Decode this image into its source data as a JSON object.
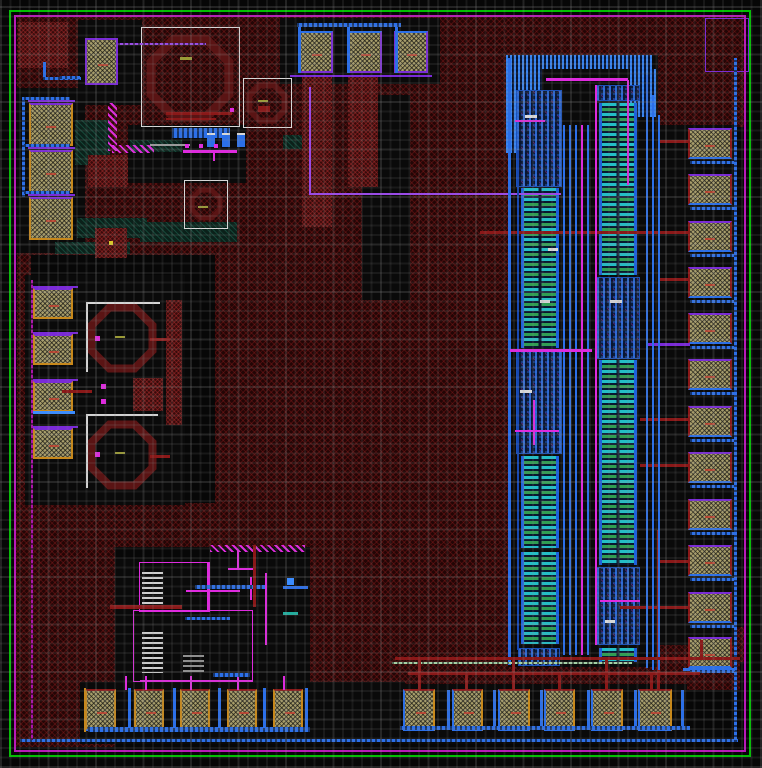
{
  "canvas": {
    "w": 762,
    "h": 768
  },
  "palette": {
    "B": "#2b6fe8",
    "BB": "#3b8cff",
    "DB": "#1848b0",
    "P": "#7a2ad8",
    "V": "#9a4ae8",
    "M": "#e028e0",
    "DM": "#aa14aa",
    "R": "#8a1818",
    "W": "#d8d8d8",
    "G": "#9a9a9a",
    "O": "#9a9a35",
    "T": "#1fae9e",
    "LG": "#a8d8a8",
    "OR": "#c8881a",
    "Y": "#d8c828",
    "IND": "#5a1414",
    "GREEN_RING": "#00c000",
    "MAGENTA_RING": "#b818b8"
  },
  "rings": [
    {
      "name": "seal-ring-green",
      "x": 9,
      "y": 10,
      "w": 742,
      "h": 747,
      "c": "GREEN_RING"
    },
    {
      "name": "seal-ring-magenta",
      "x": 14,
      "y": 15,
      "w": 732,
      "h": 737,
      "c": "MAGENTA_RING"
    }
  ],
  "regions": {
    "red": [
      [
        17,
        17,
        375,
        238
      ],
      [
        390,
        17,
        118,
        648
      ],
      [
        505,
        17,
        240,
        40
      ],
      [
        640,
        57,
        105,
        70
      ],
      [
        215,
        250,
        293,
        296
      ],
      [
        17,
        253,
        14,
        252
      ],
      [
        15,
        503,
        100,
        244
      ],
      [
        115,
        503,
        285,
        44
      ],
      [
        310,
        545,
        198,
        145
      ],
      [
        390,
        657,
        350,
        33
      ],
      [
        645,
        627,
        100,
        35
      ]
    ],
    "black": [
      [
        280,
        18,
        160,
        66
      ],
      [
        78,
        20,
        64,
        85
      ],
      [
        17,
        88,
        68,
        165
      ],
      [
        128,
        125,
        118,
        58
      ],
      [
        25,
        275,
        160,
        230
      ],
      [
        115,
        558,
        195,
        130
      ],
      [
        80,
        682,
        325,
        62
      ],
      [
        395,
        684,
        292,
        60
      ],
      [
        362,
        95,
        48,
        205
      ],
      [
        508,
        55,
        150,
        612
      ],
      [
        655,
        125,
        80,
        520
      ]
    ],
    "teal": [
      [
        75,
        120,
        35,
        45
      ],
      [
        77,
        218,
        70,
        20
      ],
      [
        130,
        140,
        52,
        12
      ],
      [
        140,
        222,
        97,
        20
      ],
      [
        55,
        242,
        75,
        12
      ],
      [
        283,
        135,
        20,
        14
      ]
    ],
    "redBoxes": [
      [
        18,
        22,
        50,
        46
      ],
      [
        88,
        155,
        40,
        32
      ],
      [
        95,
        228,
        32,
        30
      ],
      [
        302,
        77,
        30,
        150
      ],
      [
        348,
        77,
        30,
        110
      ],
      [
        133,
        378,
        30,
        33
      ],
      [
        166,
        300,
        16,
        125
      ]
    ]
  },
  "blueBands": [
    [
      506,
      55,
      146,
      14
    ],
    [
      506,
      69,
      36,
      84
    ],
    [
      630,
      69,
      26,
      48
    ]
  ],
  "transistorArrays": [
    {
      "name": "mos-array-left",
      "x": 521,
      "w": 38,
      "bars": [
        [
          188,
          160
        ],
        [
          456,
          92
        ],
        [
          552,
          92
        ]
      ],
      "clusters": [
        [
          516,
          90,
          46,
          97
        ],
        [
          516,
          350,
          46,
          104
        ],
        [
          518,
          648,
          42,
          18
        ]
      ]
    },
    {
      "name": "mos-array-right",
      "x": 599,
      "w": 38,
      "bars": [
        [
          103,
          172
        ],
        [
          360,
          205
        ],
        [
          648,
          14
        ]
      ],
      "clusters": [
        [
          596,
          85,
          44,
          16
        ],
        [
          596,
          277,
          44,
          82
        ],
        [
          596,
          567,
          44,
          78
        ]
      ]
    }
  ],
  "inductors": [
    {
      "cx": 190,
      "cy": 78,
      "r": 42,
      "sw": 9
    },
    {
      "cx": 267,
      "cy": 103,
      "r": 19,
      "sw": 6
    },
    {
      "cx": 206,
      "cy": 204,
      "r": 15,
      "sw": 5
    },
    {
      "cx": 122,
      "cy": 338,
      "r": 33,
      "sw": 8
    },
    {
      "cx": 122,
      "cy": 455,
      "r": 33,
      "sw": 8
    }
  ],
  "outlineBoxes": [
    [
      141,
      27,
      99,
      100,
      "W"
    ],
    [
      243,
      78,
      49,
      50,
      "W"
    ],
    [
      184,
      180,
      44,
      49,
      "W"
    ],
    [
      705,
      18,
      44,
      54,
      "P"
    ],
    [
      139,
      562,
      71,
      50,
      "M"
    ],
    [
      133,
      610,
      120,
      72,
      "M"
    ]
  ],
  "resistorLadders": [
    [
      142,
      572,
      21,
      34,
      "w"
    ],
    [
      142,
      632,
      21,
      41,
      "w"
    ],
    [
      183,
      655,
      21,
      19,
      "g"
    ]
  ],
  "padGroups": [
    {
      "name": "pad-top-left",
      "b": {
        "t": "P",
        "b": "P",
        "l": "P",
        "r": "P"
      },
      "pads": [
        [
          85,
          38,
          33,
          47
        ]
      ]
    },
    {
      "name": "pad-top",
      "b": {
        "t": "B",
        "b": "P",
        "l": "P",
        "r": "P"
      },
      "pads": [
        [
          299,
          31,
          34,
          42
        ],
        [
          347,
          31,
          35,
          42
        ],
        [
          394,
          31,
          34,
          42
        ]
      ]
    },
    {
      "name": "pad-left-upper",
      "b": {
        "t": "P",
        "b": "OR",
        "l": "OR",
        "r": "OR"
      },
      "pads": [
        [
          29,
          103,
          44,
          43
        ],
        [
          29,
          150,
          44,
          43
        ],
        [
          29,
          197,
          44,
          43
        ]
      ]
    },
    {
      "name": "pad-left-middle",
      "b": {
        "t": "P",
        "b": "OR",
        "l": "OR",
        "r": "OR"
      },
      "pads": [
        [
          33,
          288,
          40,
          31
        ],
        [
          33,
          334,
          40,
          31
        ],
        [
          33,
          381,
          40,
          31
        ],
        [
          33,
          428,
          40,
          31
        ]
      ]
    },
    {
      "name": "pad-right",
      "b": {
        "t": "P",
        "b": "B",
        "l": "R",
        "r": "R"
      },
      "pads": [
        [
          688,
          128,
          44,
          31
        ],
        [
          688,
          174,
          44,
          31
        ],
        [
          688,
          221,
          44,
          31
        ],
        [
          688,
          267,
          44,
          31
        ],
        [
          688,
          313,
          44,
          31
        ],
        [
          688,
          359,
          44,
          31
        ],
        [
          688,
          406,
          44,
          31
        ],
        [
          688,
          452,
          44,
          31
        ],
        [
          688,
          499,
          44,
          31
        ],
        [
          688,
          545,
          44,
          31
        ],
        [
          688,
          592,
          44,
          31
        ],
        [
          688,
          637,
          44,
          31
        ]
      ]
    },
    {
      "name": "pad-bottom-left",
      "b": {
        "t": "R",
        "b": "B",
        "l": "OR",
        "r": "OR"
      },
      "pads": [
        [
          85,
          689,
          31,
          42
        ],
        [
          134,
          689,
          30,
          42
        ],
        [
          180,
          689,
          30,
          42
        ],
        [
          227,
          689,
          30,
          42
        ],
        [
          273,
          689,
          30,
          42
        ]
      ]
    },
    {
      "name": "pad-bottom-right",
      "b": {
        "t": "R",
        "b": "B",
        "l": "B",
        "r": "OR"
      },
      "pads": [
        [
          403,
          689,
          32,
          42
        ],
        [
          452,
          689,
          31,
          42
        ],
        [
          498,
          689,
          32,
          42
        ],
        [
          544,
          689,
          31,
          42
        ],
        [
          591,
          689,
          32,
          42
        ],
        [
          638,
          689,
          34,
          42
        ]
      ]
    }
  ],
  "wires": [
    [
      297,
      23,
      104,
      4,
      "B",
      "dot"
    ],
    [
      298,
      27,
      3,
      46,
      "B"
    ],
    [
      347,
      27,
      3,
      46,
      "B"
    ],
    [
      395,
      27,
      3,
      46,
      "B"
    ],
    [
      290,
      75,
      142,
      2,
      "P"
    ],
    [
      309,
      87,
      2,
      108,
      "V"
    ],
    [
      309,
      193,
      252,
      2,
      "V"
    ],
    [
      118,
      43,
      88,
      2,
      "V",
      "dot"
    ],
    [
      22,
      97,
      3,
      100,
      "B",
      "dot"
    ],
    [
      24,
      97,
      46,
      3,
      "B",
      "dot"
    ],
    [
      24,
      144,
      46,
      3,
      "B",
      "dot"
    ],
    [
      24,
      191,
      46,
      3,
      "B",
      "dot"
    ],
    [
      43,
      62,
      3,
      17,
      "B"
    ],
    [
      43,
      77,
      38,
      3,
      "B",
      "dot"
    ],
    [
      60,
      76,
      20,
      3,
      "B",
      "dot"
    ],
    [
      172,
      128,
      58,
      10,
      "B",
      "dot"
    ],
    [
      207,
      135,
      8,
      12,
      "B"
    ],
    [
      222,
      135,
      8,
      12,
      "B"
    ],
    [
      237,
      135,
      8,
      12,
      "B"
    ],
    [
      207,
      133,
      8,
      2,
      "W"
    ],
    [
      222,
      133,
      8,
      2,
      "W"
    ],
    [
      237,
      133,
      8,
      2,
      "W"
    ],
    [
      150,
      144,
      40,
      2,
      "G"
    ],
    [
      183,
      150,
      54,
      3,
      "M"
    ],
    [
      213,
      153,
      2,
      8,
      "M"
    ],
    [
      185,
      144,
      4,
      4,
      "M"
    ],
    [
      199,
      144,
      4,
      4,
      "M"
    ],
    [
      214,
      144,
      4,
      4,
      "M"
    ],
    [
      230,
      108,
      4,
      4,
      "M"
    ],
    [
      108,
      103,
      9,
      48,
      "M",
      "hatch"
    ],
    [
      112,
      145,
      42,
      8,
      "M",
      "hatch"
    ],
    [
      166,
      112,
      66,
      3,
      "R"
    ],
    [
      166,
      118,
      50,
      2,
      "R"
    ],
    [
      258,
      106,
      12,
      6,
      "R"
    ],
    [
      31,
      411,
      44,
      3,
      "BB"
    ],
    [
      28,
      100,
      47,
      2,
      "P"
    ],
    [
      28,
      147,
      47,
      2,
      "P"
    ],
    [
      28,
      194,
      47,
      2,
      "P"
    ],
    [
      33,
      286,
      45,
      2,
      "P"
    ],
    [
      33,
      332,
      45,
      2,
      "P"
    ],
    [
      33,
      379,
      45,
      2,
      "P"
    ],
    [
      33,
      426,
      45,
      2,
      "P"
    ],
    [
      62,
      390,
      30,
      3,
      "R"
    ],
    [
      150,
      338,
      20,
      3,
      "R"
    ],
    [
      150,
      455,
      20,
      3,
      "R"
    ],
    [
      95,
      336,
      5,
      5,
      "M"
    ],
    [
      95,
      452,
      5,
      5,
      "M"
    ],
    [
      101,
      384,
      5,
      5,
      "M"
    ],
    [
      101,
      399,
      5,
      5,
      "M"
    ],
    [
      86,
      302,
      74,
      2,
      "W"
    ],
    [
      86,
      302,
      2,
      70,
      "W"
    ],
    [
      86,
      414,
      72,
      2,
      "W"
    ],
    [
      86,
      414,
      2,
      74,
      "W"
    ],
    [
      207,
      563,
      2,
      48,
      "M"
    ],
    [
      186,
      590,
      54,
      2,
      "M"
    ],
    [
      250,
      577,
      2,
      23,
      "M"
    ],
    [
      235,
      586,
      29,
      2,
      "M"
    ],
    [
      265,
      573,
      2,
      72,
      "M"
    ],
    [
      140,
      680,
      113,
      2,
      "M"
    ],
    [
      228,
      568,
      25,
      2,
      "M"
    ],
    [
      237,
      551,
      2,
      17,
      "M"
    ],
    [
      210,
      545,
      95,
      7,
      "M",
      "hatch"
    ],
    [
      125,
      676,
      2,
      14,
      "M"
    ],
    [
      145,
      676,
      2,
      14,
      "M"
    ],
    [
      190,
      676,
      2,
      14,
      "M"
    ],
    [
      237,
      676,
      2,
      14,
      "M"
    ],
    [
      283,
      676,
      2,
      14,
      "M"
    ],
    [
      195,
      585,
      70,
      4,
      "B",
      "dot"
    ],
    [
      185,
      617,
      45,
      3,
      "B",
      "dot"
    ],
    [
      213,
      673,
      37,
      4,
      "B",
      "dot"
    ],
    [
      283,
      586,
      25,
      3,
      "B"
    ],
    [
      287,
      578,
      7,
      7,
      "BB"
    ],
    [
      283,
      612,
      15,
      3,
      "T"
    ],
    [
      110,
      605,
      72,
      4,
      "R"
    ],
    [
      253,
      545,
      3,
      62,
      "R"
    ],
    [
      88,
      727,
      222,
      5,
      "B",
      "dot"
    ],
    [
      128,
      688,
      3,
      40,
      "B"
    ],
    [
      173,
      688,
      3,
      40,
      "B"
    ],
    [
      218,
      688,
      3,
      40,
      "B"
    ],
    [
      263,
      688,
      3,
      40,
      "B"
    ],
    [
      305,
      688,
      3,
      40,
      "B"
    ],
    [
      84,
      688,
      2,
      44,
      "OR"
    ],
    [
      20,
      739,
      718,
      3,
      "B",
      "dot"
    ],
    [
      734,
      58,
      3,
      684,
      "B",
      "dot"
    ],
    [
      400,
      726,
      290,
      4,
      "B",
      "dot"
    ],
    [
      447,
      690,
      3,
      36,
      "B"
    ],
    [
      493,
      690,
      3,
      36,
      "B"
    ],
    [
      540,
      690,
      3,
      36,
      "B"
    ],
    [
      587,
      690,
      3,
      36,
      "B"
    ],
    [
      634,
      690,
      3,
      36,
      "B"
    ],
    [
      681,
      690,
      3,
      36,
      "B"
    ],
    [
      683,
      668,
      52,
      3,
      "B"
    ],
    [
      660,
      140,
      30,
      3,
      "R"
    ],
    [
      480,
      231,
      208,
      3,
      "R"
    ],
    [
      660,
      278,
      28,
      3,
      "R"
    ],
    [
      640,
      418,
      48,
      3,
      "R"
    ],
    [
      640,
      464,
      48,
      3,
      "R"
    ],
    [
      660,
      560,
      28,
      3,
      "R"
    ],
    [
      657,
      530,
      3,
      160,
      "R"
    ],
    [
      620,
      606,
      68,
      3,
      "R"
    ],
    [
      648,
      343,
      42,
      3,
      "P"
    ],
    [
      690,
      161,
      44,
      3,
      "B",
      "dot"
    ],
    [
      690,
      207,
      44,
      3,
      "B",
      "dot"
    ],
    [
      690,
      254,
      44,
      3,
      "B",
      "dot"
    ],
    [
      690,
      300,
      44,
      3,
      "B",
      "dot"
    ],
    [
      690,
      346,
      44,
      3,
      "B",
      "dot"
    ],
    [
      690,
      392,
      44,
      3,
      "B",
      "dot"
    ],
    [
      690,
      439,
      44,
      3,
      "B",
      "dot"
    ],
    [
      690,
      485,
      44,
      3,
      "B",
      "dot"
    ],
    [
      690,
      532,
      44,
      3,
      "B",
      "dot"
    ],
    [
      690,
      578,
      44,
      3,
      "B",
      "dot"
    ],
    [
      690,
      625,
      44,
      3,
      "B",
      "dot"
    ],
    [
      690,
      670,
      44,
      3,
      "B",
      "dot"
    ],
    [
      508,
      58,
      3,
      607,
      "B"
    ],
    [
      646,
      75,
      2,
      593,
      "B"
    ],
    [
      652,
      95,
      2,
      575,
      "B"
    ],
    [
      658,
      115,
      2,
      555,
      "B"
    ],
    [
      517,
      150,
      2,
      500,
      "DB"
    ],
    [
      563,
      125,
      2,
      530,
      "B"
    ],
    [
      569,
      125,
      2,
      530,
      "B"
    ],
    [
      575,
      125,
      2,
      530,
      "B"
    ],
    [
      587,
      125,
      2,
      530,
      "B"
    ],
    [
      581,
      125,
      2,
      530,
      "M"
    ],
    [
      595,
      85,
      2,
      560,
      "M"
    ],
    [
      546,
      78,
      82,
      3,
      "M"
    ],
    [
      627,
      80,
      2,
      105,
      "M"
    ],
    [
      510,
      349,
      82,
      3,
      "M"
    ],
    [
      515,
      120,
      30,
      2,
      "M"
    ],
    [
      515,
      430,
      44,
      2,
      "M"
    ],
    [
      600,
      600,
      40,
      2,
      "M"
    ],
    [
      533,
      400,
      2,
      45,
      "M"
    ],
    [
      525,
      115,
      12,
      3,
      "W"
    ],
    [
      540,
      300,
      10,
      3,
      "W"
    ],
    [
      520,
      390,
      12,
      3,
      "W"
    ],
    [
      610,
      300,
      12,
      3,
      "W"
    ],
    [
      605,
      620,
      10,
      3,
      "W"
    ],
    [
      548,
      248,
      10,
      3,
      "W"
    ],
    [
      392,
      662,
      240,
      2,
      "LG",
      "dot"
    ],
    [
      395,
      657,
      345,
      3,
      "R"
    ],
    [
      408,
      672,
      292,
      3,
      "R"
    ],
    [
      418,
      660,
      3,
      30,
      "R"
    ],
    [
      465,
      675,
      3,
      15,
      "R"
    ],
    [
      512,
      660,
      3,
      30,
      "R"
    ],
    [
      558,
      675,
      3,
      15,
      "R"
    ],
    [
      605,
      660,
      3,
      30,
      "R"
    ],
    [
      650,
      675,
      3,
      15,
      "R"
    ],
    [
      700,
      640,
      3,
      20,
      "R"
    ],
    [
      31,
      280,
      2,
      460,
      "DM",
      "dot"
    ],
    [
      180,
      57,
      12,
      3,
      "O"
    ],
    [
      258,
      100,
      10,
      2,
      "O"
    ],
    [
      198,
      206,
      10,
      2,
      "O"
    ],
    [
      115,
      336,
      10,
      2,
      "O"
    ],
    [
      115,
      452,
      10,
      2,
      "O"
    ],
    [
      109,
      241,
      4,
      4,
      "Y"
    ]
  ]
}
